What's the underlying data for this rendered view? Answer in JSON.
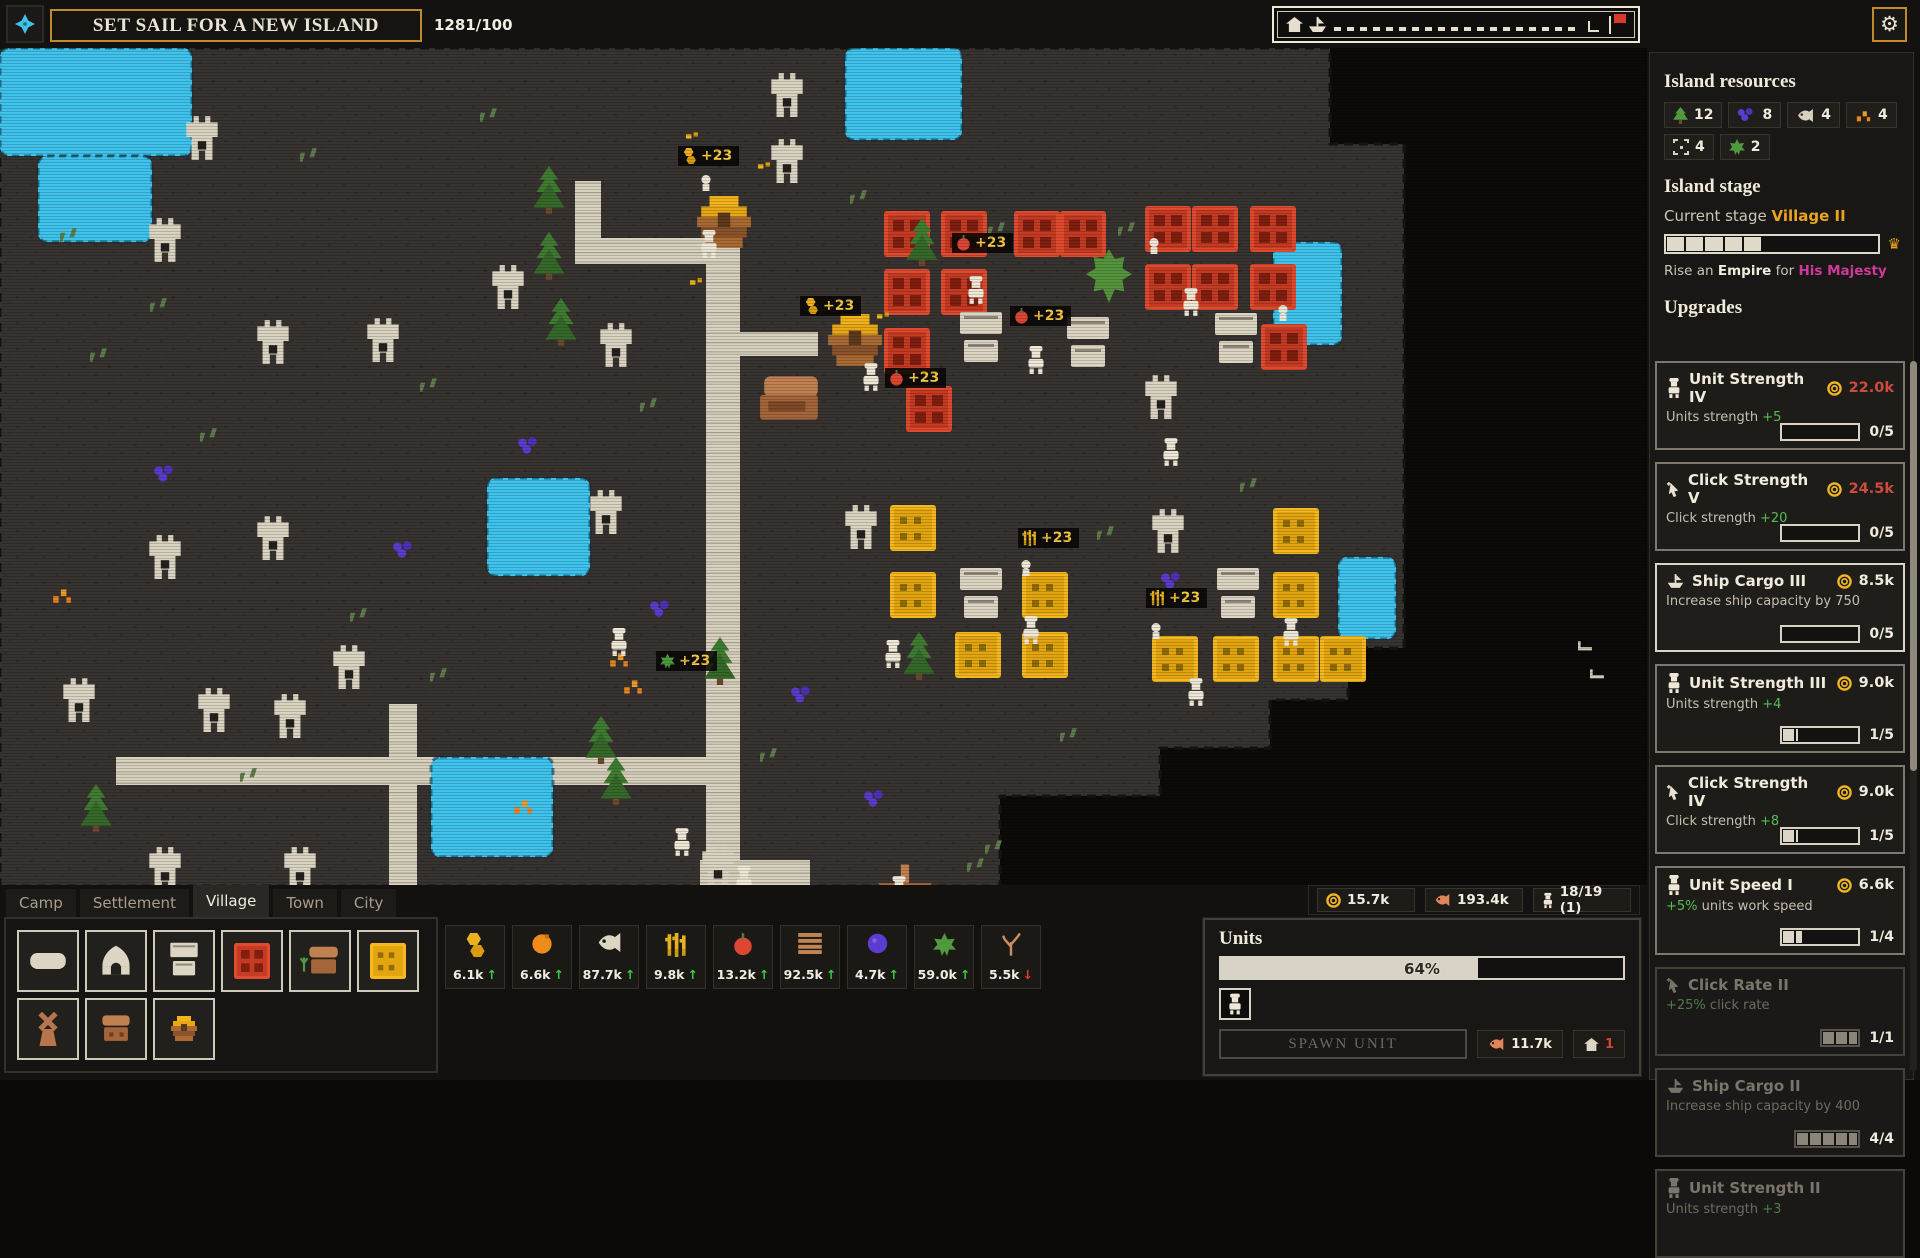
{
  "colors": {
    "accent_gold": "#c08b2a",
    "water": "#3fc3ec",
    "land": "#373330",
    "cost_red": "#cd4b3e",
    "bonus_green": "#54bc54",
    "stage_gold": "#e8a31f",
    "majesty_magenta": "#d0399c",
    "farm_red": "#e04a2e",
    "farm_yellow": "#f5b91f",
    "sprite_cream": "#ddd5c4"
  },
  "top_bar": {
    "set_sail_label": "SET SAIL FOR A NEW ISLAND",
    "cargo_counter": "1281/100",
    "gear_icon": "⚙"
  },
  "sidebar": {
    "resources_title": "Island resources",
    "resources": [
      {
        "icon": "pine",
        "count": "12"
      },
      {
        "icon": "berries",
        "count": "8"
      },
      {
        "icon": "fish",
        "count": "4"
      },
      {
        "icon": "embers",
        "count": "4"
      },
      {
        "icon": "ruins",
        "count": "4"
      },
      {
        "icon": "leaf",
        "count": "2"
      }
    ],
    "stage_title": "Island stage",
    "current_stage_label": "Current stage",
    "current_stage_value": "Village II",
    "stage_progress": {
      "filled": 5,
      "total": 11
    },
    "rise": {
      "pre": "Rise an ",
      "empire": "Empire",
      "mid": " for ",
      "majesty": "His Majesty"
    },
    "upgrades_title": "Upgrades",
    "upgrades": [
      {
        "icon": "unit",
        "name": "Unit Strength IV",
        "cost": "22.0k",
        "expensive": true,
        "desc_pre": "Units strength ",
        "desc_bonus": "+5",
        "bonus_first": false,
        "progress_label": "0/5",
        "progress": 0,
        "bar": "normal",
        "state": "normal"
      },
      {
        "icon": "cursor",
        "name": "Click Strength V",
        "cost": "24.5k",
        "expensive": true,
        "desc_pre": "Click strength ",
        "desc_bonus": "+20",
        "bonus_first": false,
        "progress_label": "0/5",
        "progress": 0,
        "bar": "normal",
        "state": "normal"
      },
      {
        "icon": "ship",
        "name": "Ship Cargo III",
        "cost": "8.5k",
        "expensive": false,
        "desc_pre": "Increase ship capacity by 750",
        "desc_bonus": "",
        "bonus_first": false,
        "progress_label": "0/5",
        "progress": 0,
        "bar": "normal",
        "state": "bright"
      },
      {
        "icon": "unit",
        "name": "Unit Strength III",
        "cost": "9.0k",
        "expensive": false,
        "desc_pre": "Units strength ",
        "desc_bonus": "+4",
        "bonus_first": false,
        "progress_label": "1/5",
        "progress": 0.2,
        "bar": "normal",
        "state": "normal"
      },
      {
        "icon": "cursor",
        "name": "Click Strength IV",
        "cost": "9.0k",
        "expensive": false,
        "desc_pre": "Click strength ",
        "desc_bonus": "+8",
        "bonus_first": false,
        "progress_label": "1/5",
        "progress": 0.2,
        "bar": "normal",
        "state": "normal"
      },
      {
        "icon": "unit",
        "name": "Unit Speed I",
        "cost": "6.6k",
        "expensive": false,
        "desc_pre": " units work speed",
        "desc_bonus": "+5%",
        "bonus_first": true,
        "progress_label": "1/4",
        "progress": 0.25,
        "bar": "normal",
        "state": "normal"
      },
      {
        "icon": "cursor",
        "name": "Click Rate II",
        "cost": "",
        "expensive": false,
        "desc_pre": " click rate",
        "desc_bonus": "+25%",
        "bonus_first": true,
        "progress_label": "1/1",
        "progress": 1,
        "bar": "small",
        "state": "dim"
      },
      {
        "icon": "ship",
        "name": "Ship Cargo II",
        "cost": "",
        "expensive": false,
        "desc_pre": "Increase ship capacity by 400",
        "desc_bonus": "",
        "bonus_first": false,
        "progress_label": "4/4",
        "progress": 1,
        "bar": "med",
        "state": "dim"
      },
      {
        "icon": "unit",
        "name": "Unit Strength II",
        "cost": "",
        "expensive": false,
        "desc_pre": "Units strength ",
        "desc_bonus": "+3",
        "bonus_first": false,
        "progress_label": "",
        "progress": 1,
        "bar": "none",
        "state": "dim"
      }
    ]
  },
  "bottom": {
    "tabs": [
      "Camp",
      "Settlement",
      "Village",
      "Town",
      "City"
    ],
    "active_tab_index": 2,
    "buildings_row1": [
      "road",
      "hut",
      "storage",
      "red-farm",
      "tanner",
      "wheat-farm"
    ],
    "buildings_row2": [
      "windmill",
      "chest",
      "hive"
    ],
    "resources": [
      {
        "icon": "honeycomb",
        "value": "6.1k",
        "trend": "up"
      },
      {
        "icon": "orange",
        "value": "6.6k",
        "trend": "up"
      },
      {
        "icon": "fish",
        "value": "87.7k",
        "trend": "up"
      },
      {
        "icon": "wheat",
        "value": "9.8k",
        "trend": "up"
      },
      {
        "icon": "apple",
        "value": "13.2k",
        "trend": "up"
      },
      {
        "icon": "planks",
        "value": "92.5k",
        "trend": "up"
      },
      {
        "icon": "berry",
        "value": "4.7k",
        "trend": "up"
      },
      {
        "icon": "leaf",
        "value": "59.0k",
        "trend": "up"
      },
      {
        "icon": "branch",
        "value": "5.5k",
        "trend": "down"
      }
    ],
    "status": [
      {
        "icon": "coin",
        "value": "15.7k"
      },
      {
        "icon": "fish",
        "value": "193.4k"
      },
      {
        "icon": "unit",
        "value": "18/19 (1)"
      }
    ],
    "units_panel": {
      "title": "Units",
      "progress_pct": "64%",
      "progress": 0.64,
      "spawn_label": "SPAWN UNIT",
      "cost_fish": "11.7k",
      "cost_house": "1"
    }
  },
  "map": {
    "land_polygon": "0,0 1330,0 1330,96 1404,96 1404,600 1348,600 1348,652 1270,652 1270,700 1160,700 1160,748 1000,748 1000,838 0,838",
    "waters": [
      [
        0,
        0,
        192,
        108
      ],
      [
        38,
        108,
        114,
        86
      ],
      [
        845,
        0,
        117,
        92
      ],
      [
        1273,
        194,
        69,
        103
      ],
      [
        1338,
        509,
        58,
        82
      ],
      [
        487,
        430,
        103,
        98
      ],
      [
        431,
        709,
        122,
        100
      ]
    ],
    "roads": [
      [
        706,
        190,
        34,
        648
      ],
      [
        116,
        709,
        592,
        28
      ],
      [
        389,
        656,
        28,
        182
      ],
      [
        575,
        190,
        132,
        26
      ],
      [
        575,
        133,
        26,
        60
      ],
      [
        740,
        284,
        78,
        24
      ],
      [
        700,
        812,
        110,
        26
      ],
      [
        850,
        842,
        104,
        26
      ]
    ],
    "red_farms": [
      [
        884,
        163
      ],
      [
        941,
        163
      ],
      [
        884,
        221
      ],
      [
        941,
        221
      ],
      [
        884,
        280
      ],
      [
        906,
        338
      ],
      [
        1014,
        163
      ],
      [
        1060,
        163
      ],
      [
        1145,
        158
      ],
      [
        1192,
        158
      ],
      [
        1250,
        158
      ],
      [
        1145,
        216
      ],
      [
        1192,
        216
      ],
      [
        1250,
        216
      ],
      [
        1261,
        276
      ]
    ],
    "yellow_farms": [
      [
        890,
        457
      ],
      [
        890,
        524
      ],
      [
        955,
        584
      ],
      [
        1022,
        524
      ],
      [
        1022,
        584
      ],
      [
        1152,
        588
      ],
      [
        1213,
        588
      ],
      [
        1273,
        460
      ],
      [
        1273,
        524
      ],
      [
        1273,
        588
      ],
      [
        1320,
        588
      ]
    ],
    "ruins": [
      [
        184,
        66
      ],
      [
        769,
        23
      ],
      [
        769,
        89
      ],
      [
        147,
        168
      ],
      [
        255,
        270
      ],
      [
        365,
        268
      ],
      [
        490,
        215
      ],
      [
        598,
        273
      ],
      [
        147,
        485
      ],
      [
        255,
        466
      ],
      [
        331,
        595
      ],
      [
        61,
        628
      ],
      [
        196,
        638
      ],
      [
        272,
        644
      ],
      [
        147,
        797
      ],
      [
        282,
        797
      ],
      [
        588,
        440
      ],
      [
        843,
        455
      ],
      [
        1150,
        459
      ],
      [
        1143,
        325
      ],
      [
        700,
        795
      ]
    ],
    "trees": [
      [
        533,
        118
      ],
      [
        533,
        184
      ],
      [
        545,
        250
      ],
      [
        906,
        170
      ],
      [
        903,
        584
      ],
      [
        704,
        589
      ],
      [
        585,
        668
      ],
      [
        600,
        709
      ],
      [
        80,
        736
      ]
    ],
    "units": [
      [
        698,
        182
      ],
      [
        860,
        315
      ],
      [
        965,
        228
      ],
      [
        1025,
        298
      ],
      [
        1180,
        240
      ],
      [
        1160,
        390
      ],
      [
        1020,
        568
      ],
      [
        882,
        592
      ],
      [
        1185,
        630
      ],
      [
        1280,
        570
      ],
      [
        733,
        818
      ],
      [
        888,
        828
      ],
      [
        671,
        780
      ],
      [
        608,
        580
      ]
    ],
    "heads": [
      [
        1148,
        190
      ],
      [
        1020,
        512
      ],
      [
        1150,
        575
      ],
      [
        700,
        127
      ],
      [
        1277,
        257
      ]
    ],
    "crates": [
      [
        958,
        264
      ],
      [
        1065,
        269
      ],
      [
        1213,
        265
      ],
      [
        958,
        520
      ],
      [
        1215,
        520
      ]
    ],
    "hives": [
      [
        695,
        148
      ],
      [
        826,
        266
      ]
    ],
    "huts": [
      [
        758,
        322
      ]
    ],
    "boats": [
      [
        876,
        812
      ]
    ],
    "berries": [
      [
        153,
        417
      ],
      [
        392,
        493
      ],
      [
        649,
        552
      ],
      [
        790,
        638
      ],
      [
        863,
        742
      ],
      [
        1160,
        524
      ],
      [
        517,
        389
      ]
    ],
    "embers": [
      [
        51,
        537
      ],
      [
        512,
        748
      ],
      [
        608,
        601
      ],
      [
        622,
        628
      ]
    ],
    "goldbits": [
      [
        758,
        114
      ],
      [
        690,
        230
      ],
      [
        686,
        84
      ],
      [
        877,
        264
      ]
    ],
    "scrubs": [
      [
        988,
        174
      ],
      [
        1118,
        174
      ],
      [
        1097,
        478
      ],
      [
        850,
        142
      ],
      [
        967,
        810
      ],
      [
        985,
        792
      ],
      [
        300,
        100
      ],
      [
        420,
        330
      ],
      [
        200,
        380
      ],
      [
        90,
        300
      ],
      [
        640,
        350
      ],
      [
        1240,
        430
      ],
      [
        480,
        60
      ],
      [
        60,
        180
      ],
      [
        350,
        560
      ],
      [
        240,
        720
      ],
      [
        430,
        620
      ],
      [
        1060,
        680
      ],
      [
        760,
        700
      ],
      [
        150,
        250
      ]
    ],
    "marks": [
      [
        1578,
        592
      ],
      [
        1590,
        620
      ]
    ],
    "bigleaf": [
      [
        1086,
        200
      ]
    ],
    "labels": [
      {
        "x": 678,
        "y": 98,
        "icon": "honeycomb",
        "text": "+23"
      },
      {
        "x": 800,
        "y": 248,
        "icon": "honeycomb",
        "text": "+23"
      },
      {
        "x": 952,
        "y": 185,
        "icon": "apple",
        "text": "+23"
      },
      {
        "x": 1010,
        "y": 258,
        "icon": "apple",
        "text": "+23"
      },
      {
        "x": 885,
        "y": 320,
        "icon": "apple",
        "text": "+23"
      },
      {
        "x": 1018,
        "y": 480,
        "icon": "wheat",
        "text": "+23"
      },
      {
        "x": 1146,
        "y": 540,
        "icon": "wheat",
        "text": "+23"
      },
      {
        "x": 656,
        "y": 603,
        "icon": "leaf",
        "text": "+23"
      }
    ]
  }
}
